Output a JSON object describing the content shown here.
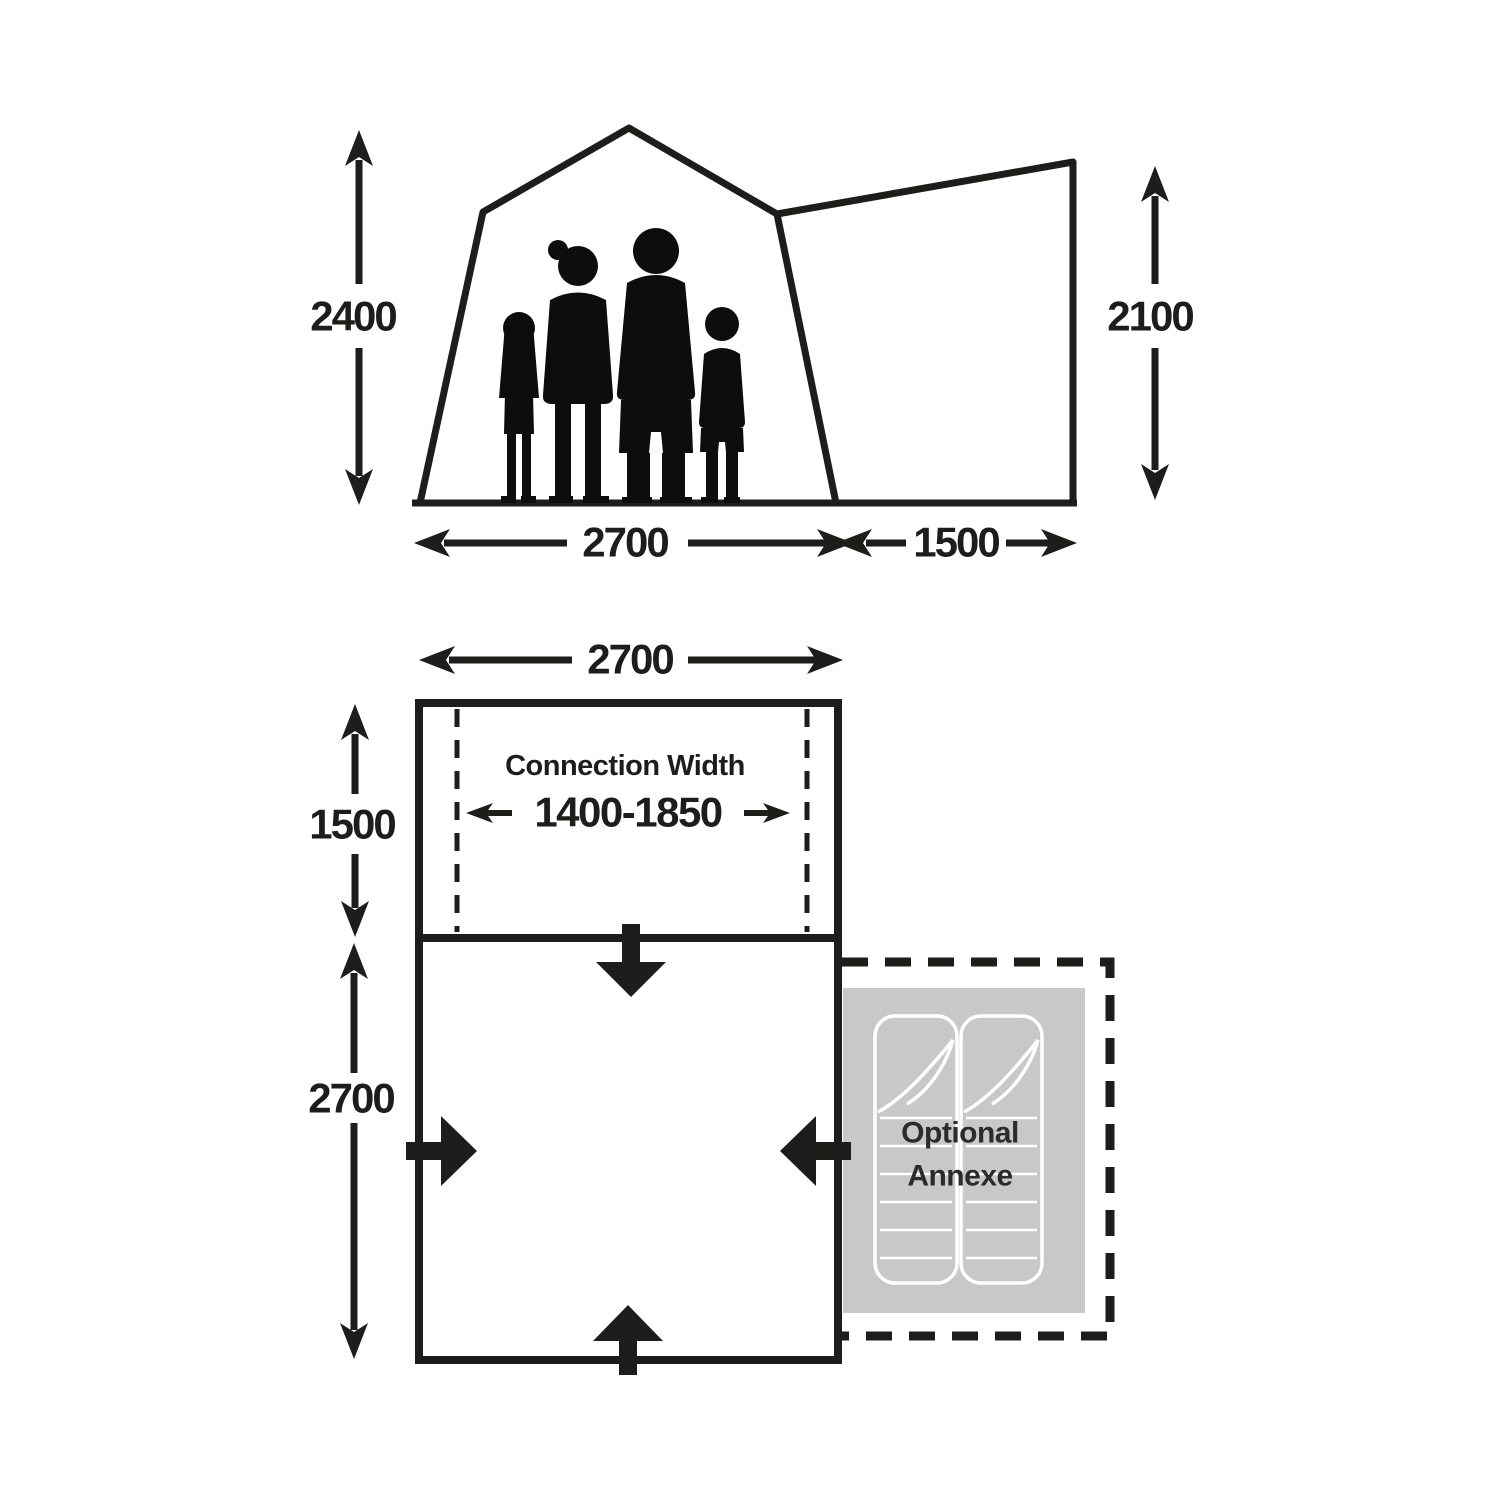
{
  "colors": {
    "ink": "#1d1d1b",
    "annexe_gray": "#c8c8c8",
    "bag_outline": "#ffffff",
    "annexe_text": "#2b2b2b",
    "background": "#ffffff"
  },
  "elevation": {
    "left_height": "2400",
    "right_height": "2100",
    "main_width": "2700",
    "side_width": "1500"
  },
  "floorplan": {
    "top_width": "2700",
    "connection_depth": "1500",
    "main_depth": "2700",
    "connection_title": "Connection Width",
    "connection_range": "1400-1850",
    "annexe_line1": "Optional",
    "annexe_line2": "Annexe"
  }
}
